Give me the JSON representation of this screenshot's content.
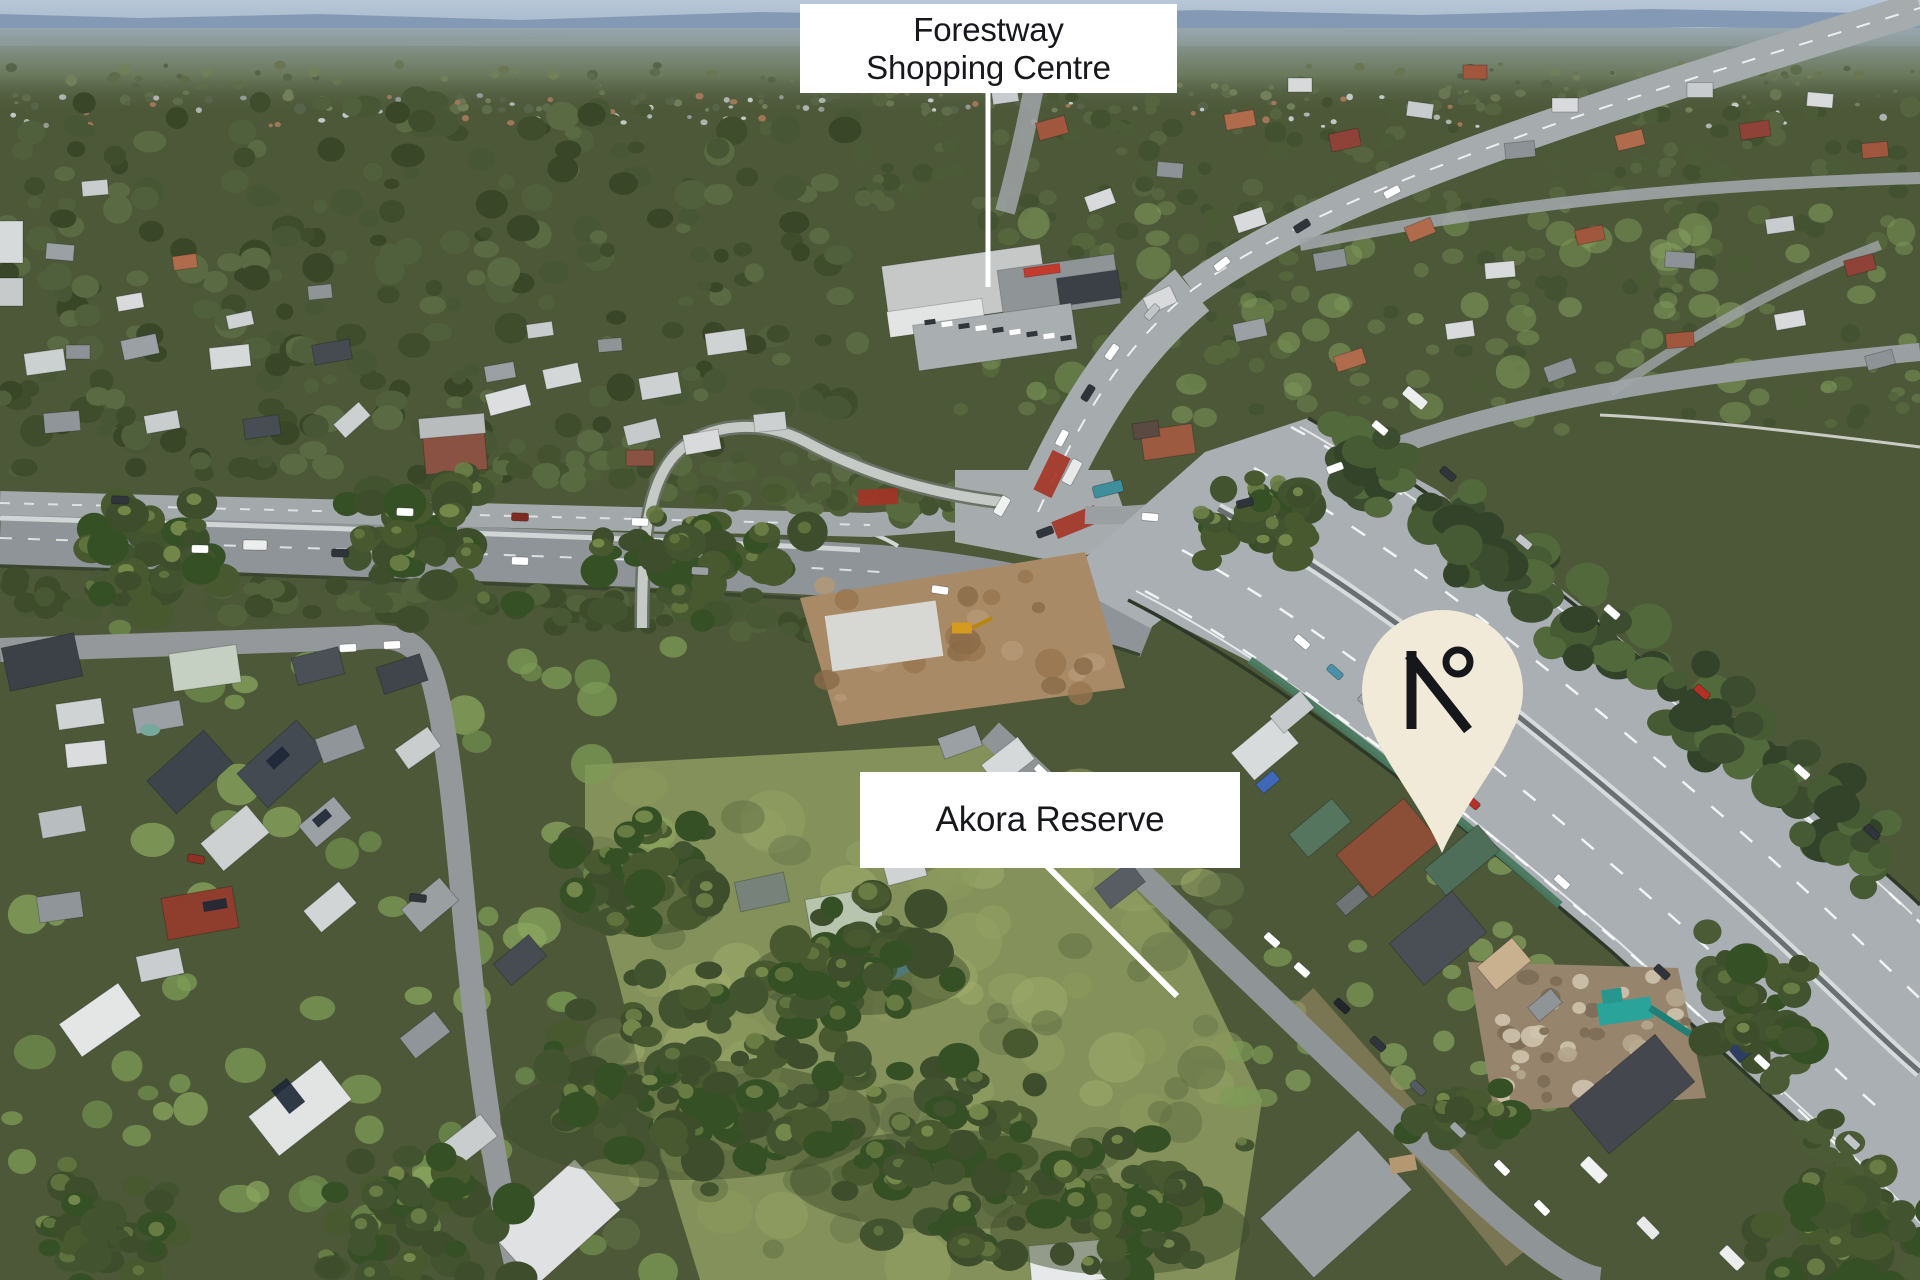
{
  "annotations": {
    "forestway": {
      "line1": "Forestway",
      "line2": "Shopping Centre"
    },
    "akora": {
      "text": "Akora Reserve"
    },
    "pin": {
      "logo": "N°",
      "fill": "#f1ead9",
      "glyph_color": "#16171b"
    },
    "style": {
      "label_background": "#ffffff",
      "label_text_color": "#17181c",
      "leader_line_color": "#ffffff"
    }
  }
}
